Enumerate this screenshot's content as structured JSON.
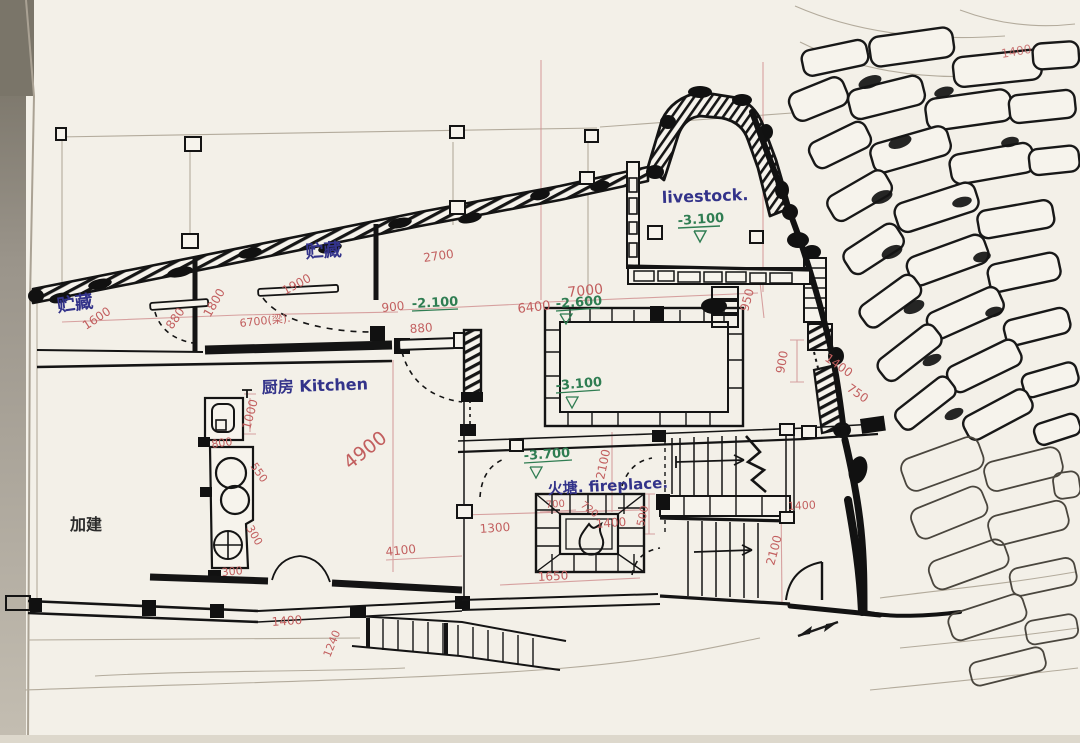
{
  "labels": {
    "storage_left": "贮藏",
    "storage_mid": "贮藏",
    "kitchen": "厨房 Kitchen",
    "livestock": "livestock.",
    "fireplace": "火塘. fireplace.",
    "addition": "加建"
  },
  "elevations": {
    "livestock": "-3.100",
    "entry": "-2.100",
    "courtyard_upper": "-2.600",
    "courtyard": "-3.100",
    "hall": "-3.700"
  },
  "dims": {
    "left_1600": "1600",
    "left_880": "880",
    "left_1800": "1800",
    "beam": "6700(梁).",
    "storage_1900": "1900",
    "storage_2700": "2700",
    "door_900": "900",
    "door_880": "880",
    "court_6400": "6400",
    "court_7000": "7000",
    "tr_1400": "1400",
    "right_950": "950",
    "right_900": "900",
    "right_1400": "1400",
    "right_750": "750",
    "sink_1000": "1000",
    "sink_800": "800",
    "counter_550": "550",
    "counter_300a": "300",
    "counter_300b": "300",
    "kitchen_4900": "4900",
    "kitchen_4100": "4100",
    "hall_1300": "1300",
    "hall_1400": "1400",
    "hall_1650": "1650",
    "fire_700": "700",
    "fire_720": "720",
    "hall_2100": "2100",
    "stair_500": "500",
    "stair_1400": "1400",
    "stair_2100": "2100",
    "bottom_1400": "1400",
    "bottom_1240": "1240"
  },
  "colors": {
    "ink": "#1b1b1b",
    "label_ink": "#33338a",
    "dim_ink": "#c25f5f",
    "elev_ink": "#2f7d52",
    "paper": "#f3f0e8",
    "pencil": "#b3ab9c"
  }
}
